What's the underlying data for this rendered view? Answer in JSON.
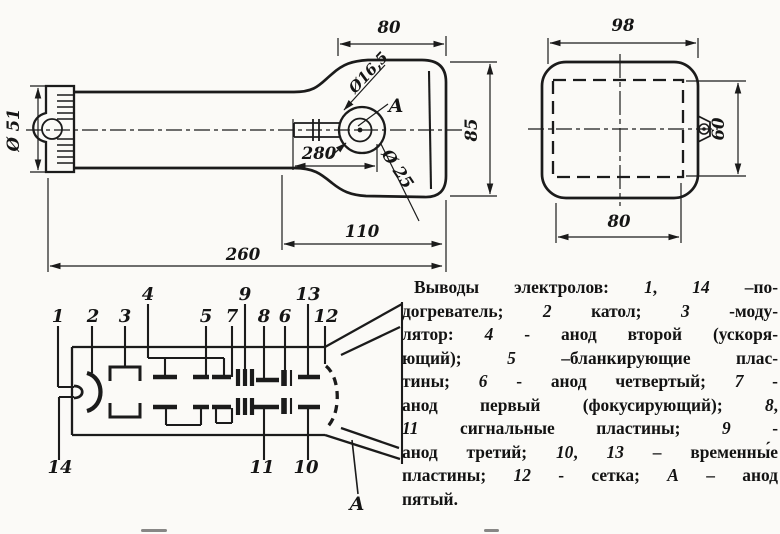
{
  "colors": {
    "ink": "#1b1b1b",
    "paper": "#fbfaf7"
  },
  "side_view": {
    "dims": {
      "neck_diameter": "Ø 51",
      "bulb_width": "80",
      "screen_height": "85",
      "anode_cap_small": "Ø16,5",
      "anode_cap_large": "Ø 25",
      "anode_offset": "280",
      "bulb_length": "110",
      "total_length": "260"
    },
    "anode_label": "A"
  },
  "front_view": {
    "dims": {
      "face_width": "98",
      "raster_height": "60",
      "raster_width": "80"
    }
  },
  "gun": {
    "p1": "1",
    "p2": "2",
    "p3": "3",
    "p4": "4",
    "p5": "5",
    "p6": "6",
    "p7": "7",
    "p8": "8",
    "p9": "9",
    "p10": "10",
    "p11": "11",
    "p12": "12",
    "p13": "13",
    "p14": "14",
    "anode_label": "A"
  },
  "legend": {
    "lines": [
      [
        [
          "Выводы электролов: ",
          0
        ],
        [
          "1",
          1
        ],
        [
          ", ",
          0
        ],
        [
          "14",
          1
        ],
        [
          " –по-",
          0
        ]
      ],
      [
        [
          "догреватель; ",
          0
        ],
        [
          "2",
          1
        ],
        [
          " катол; ",
          0
        ],
        [
          "3",
          1
        ],
        [
          " -моду-",
          0
        ]
      ],
      [
        [
          "лятор: ",
          0
        ],
        [
          "4",
          1
        ],
        [
          " - анод второй (ускоря-",
          0
        ]
      ],
      [
        [
          "ющий); ",
          0
        ],
        [
          "5",
          1
        ],
        [
          " –бланкирующие плас-",
          0
        ]
      ],
      [
        [
          "тины; ",
          0
        ],
        [
          "6",
          1
        ],
        [
          " - анод четвертый; ",
          0
        ],
        [
          "7",
          1
        ],
        [
          " -",
          0
        ]
      ],
      [
        [
          "анод первый (фокусирующий); ",
          0
        ],
        [
          "8",
          1
        ],
        [
          ",",
          0
        ]
      ],
      [
        [
          "11",
          1
        ],
        [
          " сигнальные пластины; ",
          0
        ],
        [
          "9",
          1
        ],
        [
          " -",
          0
        ]
      ],
      [
        [
          "анод третий; ",
          0
        ],
        [
          "10",
          1
        ],
        [
          ", ",
          0
        ],
        [
          "13",
          1
        ],
        [
          " – временны́е",
          0
        ]
      ],
      [
        [
          "пластины; ",
          0
        ],
        [
          "12",
          1
        ],
        [
          " - сетка; ",
          0
        ],
        [
          "А",
          1
        ],
        [
          " – анод",
          0
        ]
      ],
      [
        [
          "пятый.",
          0
        ]
      ]
    ]
  }
}
